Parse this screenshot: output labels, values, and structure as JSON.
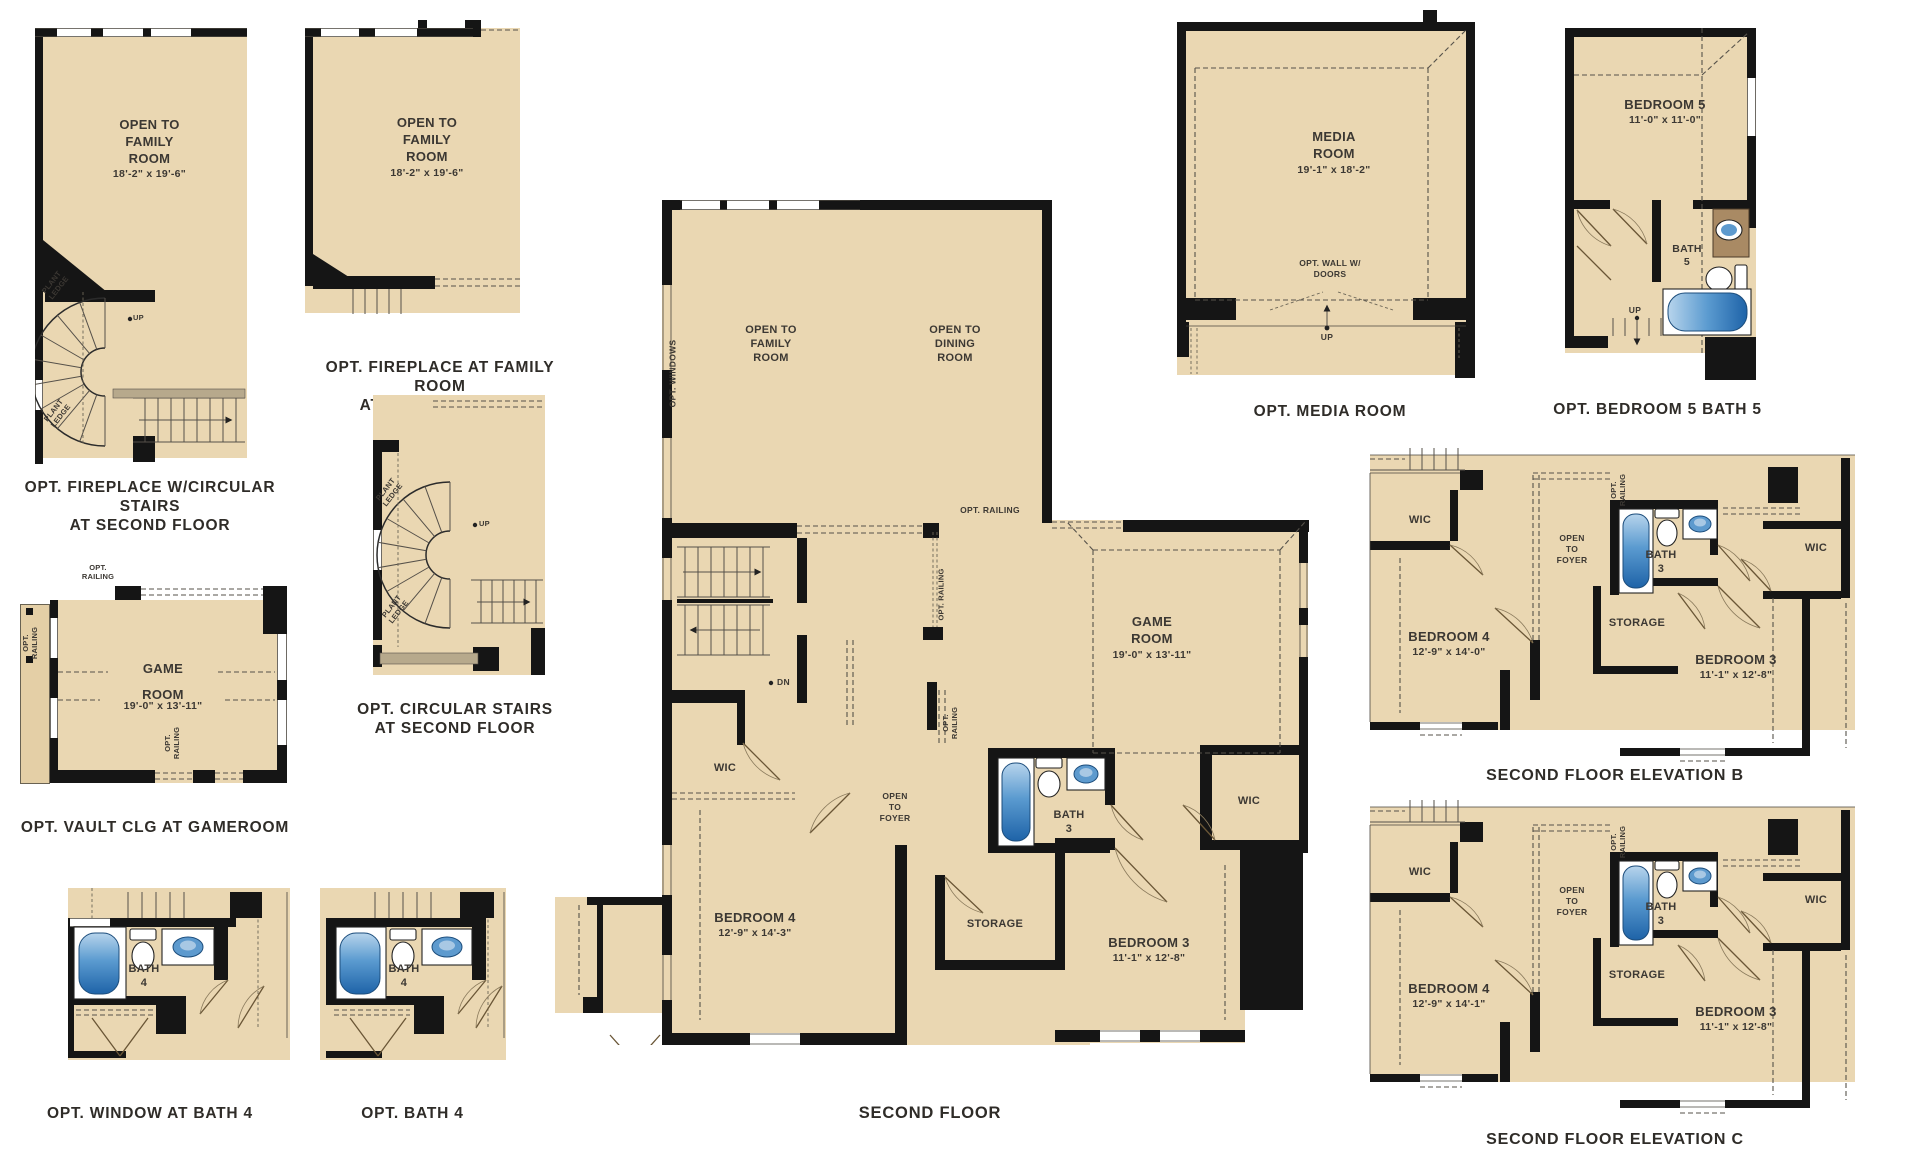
{
  "sheet": {
    "floor_name": "SECOND FLOOR",
    "colors": {
      "floor_tan": "#ead7b2",
      "wall_black": "#151515",
      "tub_blue": "#2f6fb5",
      "sink_blue": "#5d9ace",
      "counter_brown": "#a98a64",
      "ledge_gray": "#b7a98c",
      "label_text": "#3c3833"
    }
  },
  "panels": {
    "fireplace_circular_stairs": {
      "caption": "OPT. FIREPLACE W/CIRCULAR STAIRS\nAT SECOND FLOOR",
      "open_to_family_room": "OPEN TO\nFAMILY\nROOM",
      "family_room_dims": "18'-2\" x 19'-6\"",
      "plant_ledge_upper": "PLANT\nLEDGE",
      "plant_ledge_lower": "PLANT\nLEDGE",
      "up": "UP"
    },
    "fireplace_family_room": {
      "caption": "OPT. FIREPLACE AT FAMILY ROOM\nAT SECOND FLOOR",
      "open_to_family_room": "OPEN TO\nFAMILY\nROOM",
      "family_room_dims": "18'-2\" x 19'-6\""
    },
    "vault_clg_gameroom": {
      "caption": "OPT. VAULT CLG AT GAMEROOM",
      "game_room": "GAME\nROOM",
      "game_room_dims": "19'-0\" x 13'-11\"",
      "opt_railing_top": "OPT.\nRAILING",
      "opt_railing_left": "OPT.\nRAILING",
      "opt_railing_bottom": "OPT.\nRAILING"
    },
    "circular_stairs": {
      "caption": "OPT. CIRCULAR STAIRS\nAT SECOND FLOOR",
      "plant_ledge_upper": "PLANT\nLEDGE",
      "plant_ledge_lower": "PLANT\nLEDGE",
      "up": "UP"
    },
    "window_at_bath4": {
      "caption": "OPT. WINDOW AT BATH 4",
      "bath": "BATH\n4"
    },
    "bath4": {
      "caption": "OPT. BATH 4",
      "bath": "BATH\n4"
    },
    "second_floor": {
      "caption": "SECOND FLOOR",
      "opt_windows": "OPT. WINDOWS",
      "open_to_family_room": "OPEN TO\nFAMILY\nROOM",
      "open_to_dining_room": "OPEN TO\nDINING\nROOM",
      "opt_railing_top": "OPT. RAILING",
      "opt_railing_stair": "OPT. RAILING",
      "opt_railing_bath": "OPT.\nRAILING",
      "game_room": "GAME\nROOM",
      "game_room_dims": "19'-0\" x 13'-11\"",
      "dn": "DN",
      "wic_left": "WIC",
      "open_to_foyer": "OPEN\nTO\nFOYER",
      "bath3": "BATH\n3",
      "wic_right": "WIC",
      "bedroom4": "BEDROOM 4",
      "bedroom4_dims": "12'-9\" x 14'-3\"",
      "storage": "STORAGE",
      "bedroom3": "BEDROOM 3",
      "bedroom3_dims": "11'-1\" x 12'-8\""
    },
    "media_room": {
      "caption": "OPT. MEDIA ROOM",
      "media_room": "MEDIA\nROOM",
      "media_room_dims": "19'-1\" x 18'-2\"",
      "opt_wall": "OPT. WALL W/\nDOORS",
      "up": "UP"
    },
    "bedroom5_bath5": {
      "caption": "OPT. BEDROOM 5 BATH 5",
      "bedroom5": "BEDROOM 5",
      "bedroom5_dims": "11'-0\" x 11'-0\"",
      "bath5": "BATH\n5",
      "up": "UP"
    },
    "elevation_b": {
      "caption": "SECOND FLOOR ELEVATION B",
      "wic_left": "WIC",
      "open_to_foyer": "OPEN\nTO\nFOYER",
      "opt_railing": "OPT.\nRAILING",
      "bath3": "BATH\n3",
      "wic_right": "WIC",
      "bedroom4": "BEDROOM 4",
      "bedroom4_dims": "12'-9\" x 14'-0\"",
      "storage": "STORAGE",
      "bedroom3": "BEDROOM 3",
      "bedroom3_dims": "11'-1\" x 12'-8\""
    },
    "elevation_c": {
      "caption": "SECOND FLOOR ELEVATION C",
      "wic_left": "WIC",
      "open_to_foyer": "OPEN\nTO\nFOYER",
      "opt_railing": "OPT.\nRAILING",
      "bath3": "BATH\n3",
      "wic_right": "WIC",
      "bedroom4": "BEDROOM 4",
      "bedroom4_dims": "12'-9\" x 14'-1\"",
      "storage": "STORAGE",
      "bedroom3": "BEDROOM 3",
      "bedroom3_dims": "11'-1\" x 12'-8\""
    }
  }
}
